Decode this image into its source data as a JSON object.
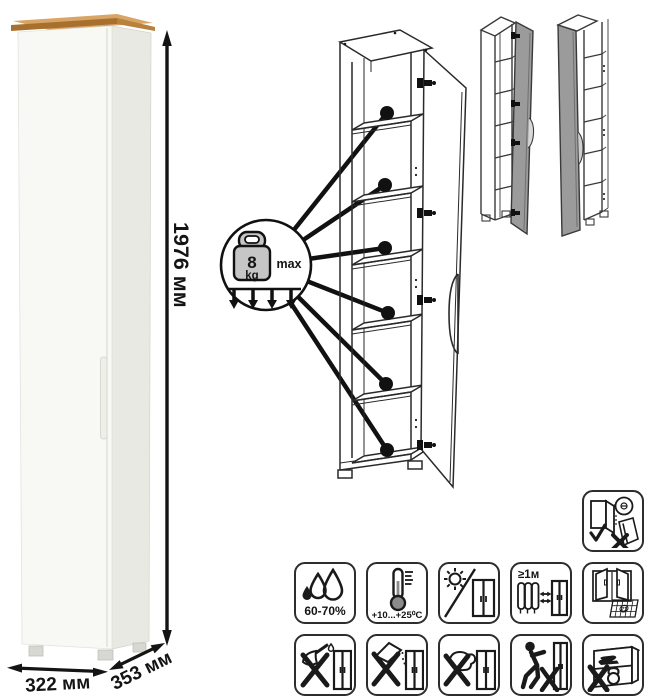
{
  "product_photo": {
    "dimensions": {
      "height": "1976 мм",
      "width": "322 мм",
      "depth": "353 мм"
    }
  },
  "shelf_load_callout": {
    "weight": "8",
    "unit": "kg",
    "qualifier": "max"
  },
  "care_instructions": {
    "humidity": "60-70%",
    "temperature": "+10...+25⁰C",
    "heat_distance": "≥1м",
    "ventilation_calendar_day": "21"
  },
  "icon_legend": [
    {
      "name": "humidity-range"
    },
    {
      "name": "temperature-range"
    },
    {
      "name": "no-direct-sunlight"
    },
    {
      "name": "min-1m-from-heaters"
    },
    {
      "name": "ventilate-room"
    },
    {
      "name": "no-sharp-tools"
    },
    {
      "name": "no-abrasive-powders"
    },
    {
      "name": "no-wet-abrasive-cleaning"
    },
    {
      "name": "do-not-drag"
    },
    {
      "name": "no-heavy-objects"
    },
    {
      "name": "door-installation-check"
    }
  ],
  "colors": {
    "wood_top": "#c3884e",
    "cabinet_front": "#f8f8f5",
    "cabinet_side": "#e9e9e3",
    "diagram_line": "#1a1a1a",
    "variant_door_gray": "#9b9b9b",
    "weight_fill": "#c6c6c6"
  }
}
